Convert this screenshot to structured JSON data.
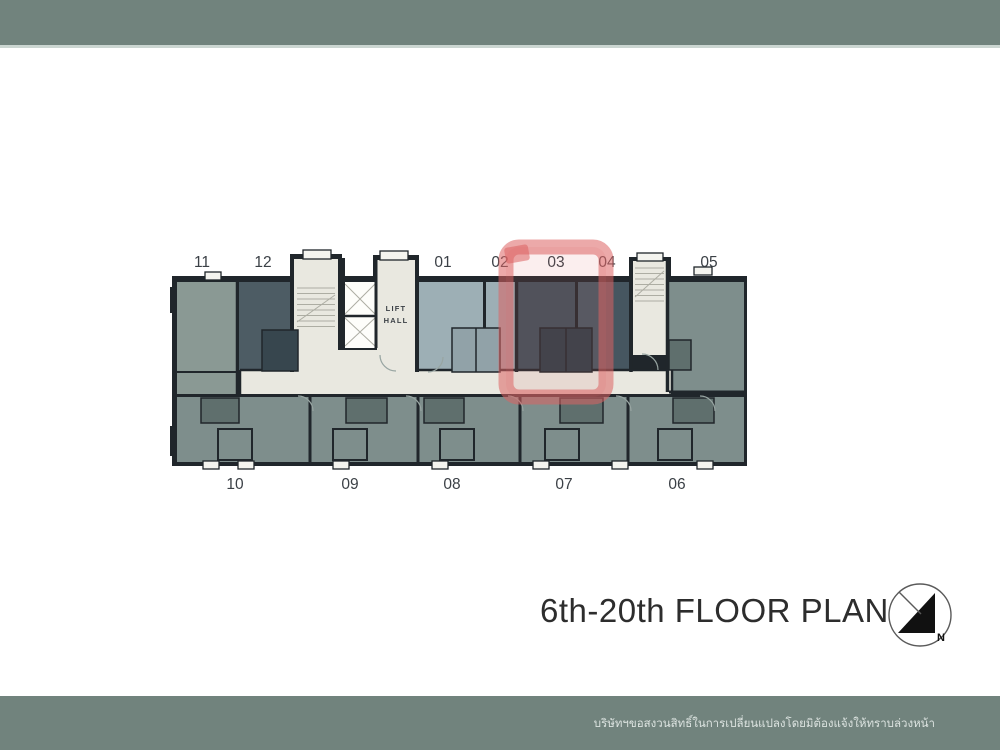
{
  "colors": {
    "band": "#71837d",
    "band_edge": "#cbd6d1",
    "wall": "#20262b",
    "corridor": "#e9e8e0",
    "lift_white": "#fdfdfa",
    "unit_light": "#9dafb5",
    "unit_dark": "#3e4e58",
    "unit_dark2": "#465660",
    "unit_mid": "#7e8e8c",
    "unit_11": "#8a9994",
    "unit_12": "#4d5c64",
    "pod_dark": "#5f6f6d",
    "pod_darker": "#2e3d46",
    "pod_light": "#91a2a8",
    "pod_12": "#37464e",
    "vent": "#f4f4ef",
    "stair_line": "#adada3",
    "arc": "#98a5a2",
    "label": "#3b4046",
    "title": "#2d2d2d",
    "footer_text": "#dce3e0",
    "compass_line": "#5a5a5a",
    "compass_fill": "#111111",
    "highlight_stroke": "rgba(220,98,98,0.55)",
    "highlight_fill": "rgba(225,112,112,0.12)"
  },
  "plan": {
    "units_top": [
      "11",
      "12",
      "01",
      "02",
      "03",
      "04",
      "05"
    ],
    "units_bottom": [
      "10",
      "09",
      "08",
      "07",
      "06"
    ],
    "lift_hall": {
      "line1": "LIFT",
      "line2": "HALL"
    },
    "highlighted_unit": "03"
  },
  "title": {
    "text": "6th-20th FLOOR PLAN"
  },
  "compass": {
    "north_label": "N"
  },
  "footer": {
    "disclaimer": "บริษัทฯขอสงวนสิทธิ์ในการเปลี่ยนแปลงโดยมิต้องแจ้งให้ทราบล่วงหน้า"
  }
}
